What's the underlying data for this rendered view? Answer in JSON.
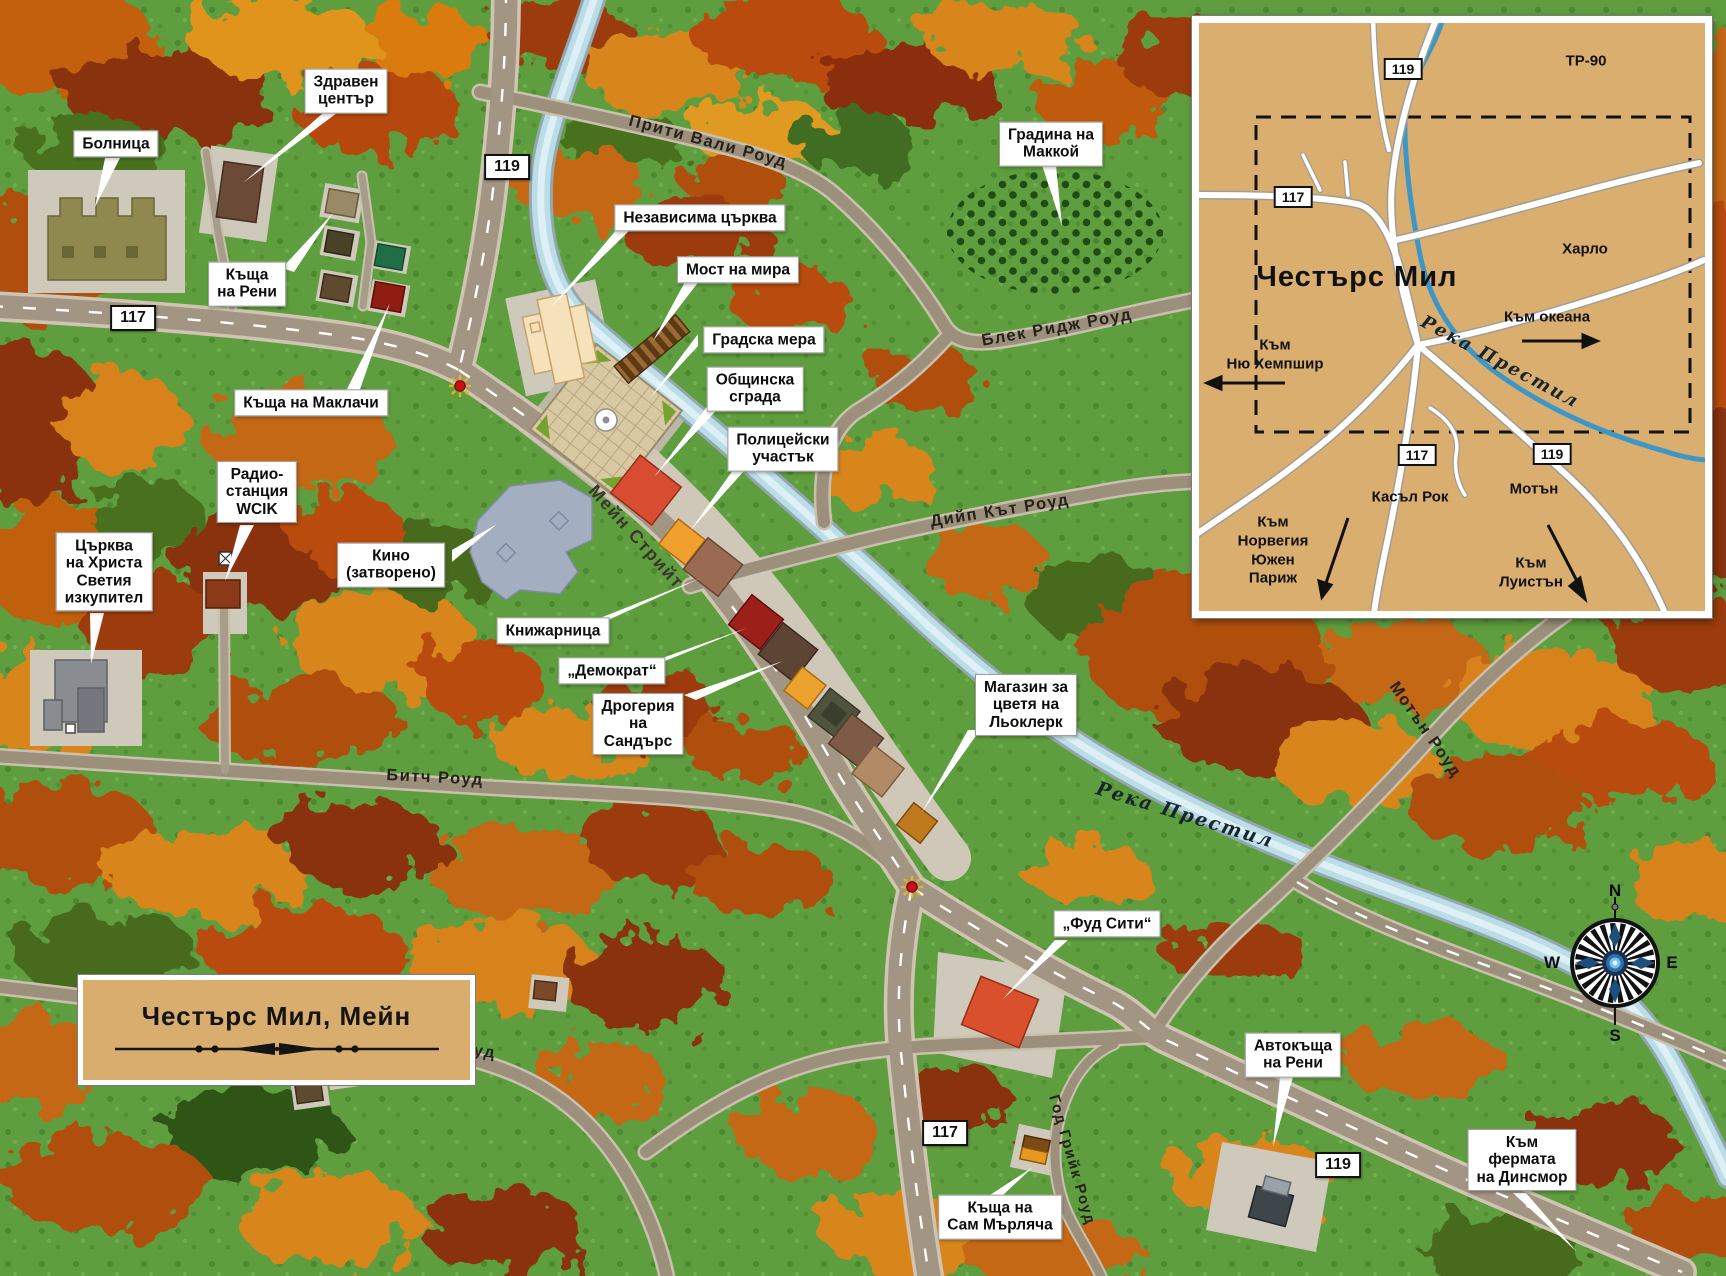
{
  "legend": {
    "title": "Честърс Мил, Мейн"
  },
  "compass": {
    "north": "N",
    "east": "E",
    "south": "S",
    "west": "W"
  },
  "shields": [
    {
      "id": "route-119-north",
      "num": "119"
    },
    {
      "id": "route-117-west",
      "num": "117"
    },
    {
      "id": "route-117-south",
      "num": "117"
    },
    {
      "id": "route-119-southeast",
      "num": "119"
    }
  ],
  "roads": [
    {
      "id": "pretty-valley",
      "label": "Прити Вали Роуд"
    },
    {
      "id": "black-ridge",
      "label": "Блек Ридж Роуд"
    },
    {
      "id": "deep-cut",
      "label": "Дийп Кът Роуд"
    },
    {
      "id": "main-street",
      "label": "Мейн Стрийт"
    },
    {
      "id": "bitch-road",
      "label": "Битч Роуд"
    },
    {
      "id": "motton-road-east",
      "label": "Мотън Роуд"
    },
    {
      "id": "motton-road-west",
      "label": "Мотън Роуд"
    },
    {
      "id": "god-creek",
      "label": "Год Грийк Роуд"
    }
  ],
  "river": {
    "label": "Река Престил"
  },
  "callouts": [
    {
      "id": "hospital",
      "text": "Болница"
    },
    {
      "id": "health-center",
      "text": "Здравен\nцентър"
    },
    {
      "id": "renie-house",
      "text": "Къща\nна Рени"
    },
    {
      "id": "mcclatchey-house",
      "text": "Къща на Маклачи"
    },
    {
      "id": "independent-church",
      "text": "Независима църква"
    },
    {
      "id": "peace-bridge",
      "text": "Мост на мира"
    },
    {
      "id": "town-common",
      "text": "Градска мера"
    },
    {
      "id": "town-hall",
      "text": "Общинска\nсграда"
    },
    {
      "id": "police-station",
      "text": "Полицейски\nучастък"
    },
    {
      "id": "mccoy-garden",
      "text": "Градина на\nМаккой"
    },
    {
      "id": "wcik-radio",
      "text": "Радио-\nстанция\nWCIK"
    },
    {
      "id": "christ-church",
      "text": "Църква\nна Христа\nСветия\nизкупител"
    },
    {
      "id": "cinema",
      "text": "Кино\n(затворено)"
    },
    {
      "id": "bookstore",
      "text": "Книжарница"
    },
    {
      "id": "democrat",
      "text": "„Демократ“"
    },
    {
      "id": "sanders-drugstore",
      "text": "Дрогерия\nна\nСандърс"
    },
    {
      "id": "leclerc-flowers",
      "text": "Магазин за\nцветя на\nЛьоклерк"
    },
    {
      "id": "food-city",
      "text": "„Фуд Сити“"
    },
    {
      "id": "renie-dealership",
      "text": "Автокъща\nна Рени"
    },
    {
      "id": "sam-house",
      "text": "Къща на\nСам Мърляча"
    },
    {
      "id": "dinsmore-farm",
      "text": "Към\nфермата\nна Динсмор"
    }
  ],
  "inset": {
    "title": "Честърс Мил",
    "areas": [
      {
        "id": "tr90",
        "text": "ТР-90"
      },
      {
        "id": "harlow",
        "text": "Харло"
      },
      {
        "id": "castle-rock",
        "text": "Касъл Рок"
      },
      {
        "id": "motton",
        "text": "Мотън"
      }
    ],
    "directions": [
      {
        "id": "to-ocean",
        "text": "Към океана"
      },
      {
        "id": "to-new-hampshire",
        "text": "Към\nНю Хемпшир"
      },
      {
        "id": "to-norway-south-paris",
        "text": "Към\nНорвегия\nЮжен\nПариж"
      },
      {
        "id": "to-lewiston",
        "text": "Към\nЛуистън"
      }
    ],
    "river": "Река Престил",
    "shields": [
      {
        "id": "inset-119-top",
        "num": "119"
      },
      {
        "id": "inset-117-left",
        "num": "117"
      },
      {
        "id": "inset-117-bottom",
        "num": "117"
      },
      {
        "id": "inset-119-bottom",
        "num": "119"
      }
    ]
  },
  "colors": {
    "grass": "#5f9e3e",
    "road_fill": "#9c907d",
    "main_road_fill": "#a39583",
    "river": "#badde7",
    "inset_bg": "#d9ae6e",
    "forest_orange": "#d8861a",
    "forest_red": "#8a3008",
    "forest_green": "#476b1d",
    "callout_bg": "#ffffff",
    "town_hall_building": "#d84c30",
    "police_building": "#f0a02c",
    "food_city_building": "#d8502c",
    "traffic_light": "#c81010"
  }
}
